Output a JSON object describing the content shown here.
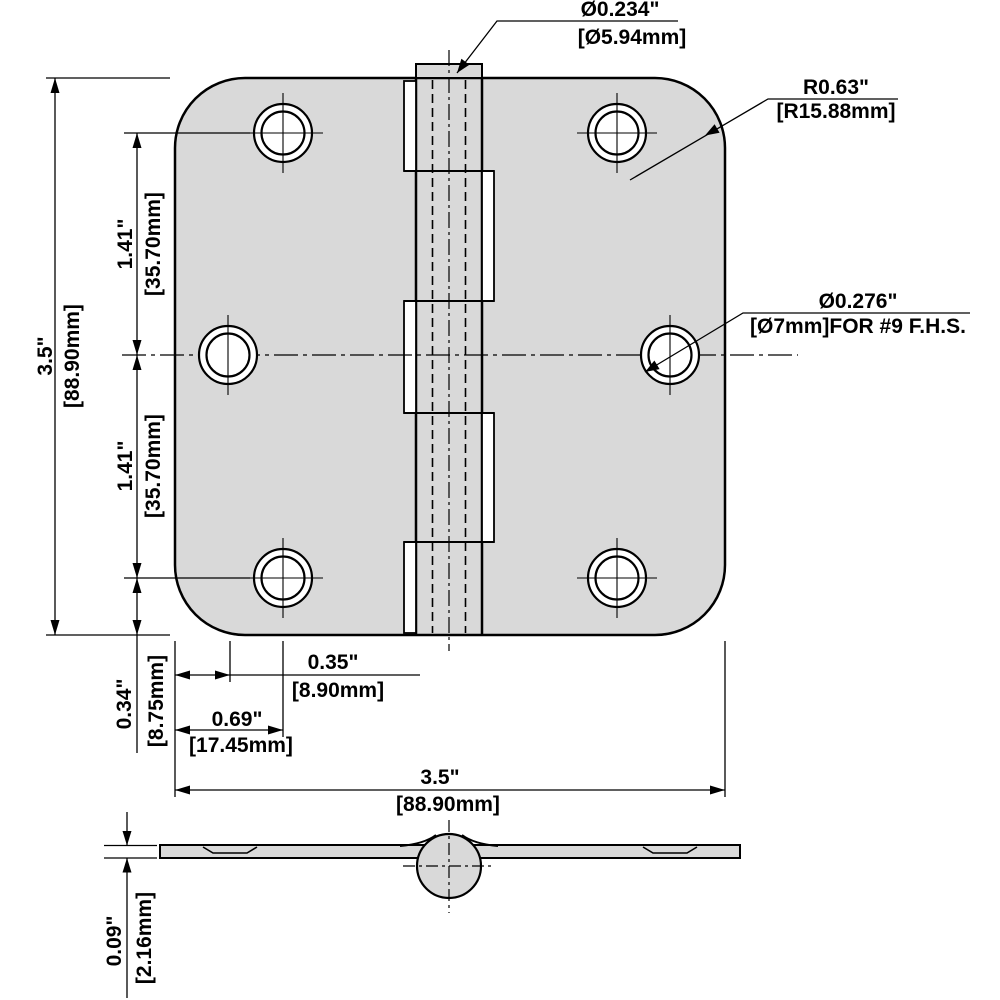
{
  "front_view": {
    "pin_diameter": {
      "inch": "Ø0.234\"",
      "mm": "[Ø5.94mm]"
    },
    "corner_radius": {
      "inch": "R0.63\"",
      "mm": "[R15.88mm]"
    },
    "screw_hole_diameter": {
      "inch": "Ø0.276\"",
      "mm": "[Ø7mm]FOR #9 F.H.S."
    },
    "overall_height": {
      "inch": "3.5\"",
      "mm": "[88.90mm]"
    },
    "hole_spacing_upper": {
      "inch": "1.41\"",
      "mm": "[35.70mm]"
    },
    "hole_spacing_lower": {
      "inch": "1.41\"",
      "mm": "[35.70mm]"
    },
    "edge_to_hole_vertical": {
      "inch": "0.34\"",
      "mm": "[8.75mm]"
    },
    "edge_to_middle_hole": {
      "inch": "0.35\"",
      "mm": "[8.90mm]"
    },
    "edge_to_corner_holes": {
      "inch": "0.69\"",
      "mm": "[17.45mm]"
    },
    "overall_width": {
      "inch": "3.5\"",
      "mm": "[88.90mm]"
    }
  },
  "side_view": {
    "leaf_thickness": {
      "inch": "0.09\"",
      "mm": "[2.16mm]"
    }
  },
  "colors": {
    "plate_fill": "#d9d9d9",
    "line": "#000000",
    "background": "#ffffff"
  }
}
